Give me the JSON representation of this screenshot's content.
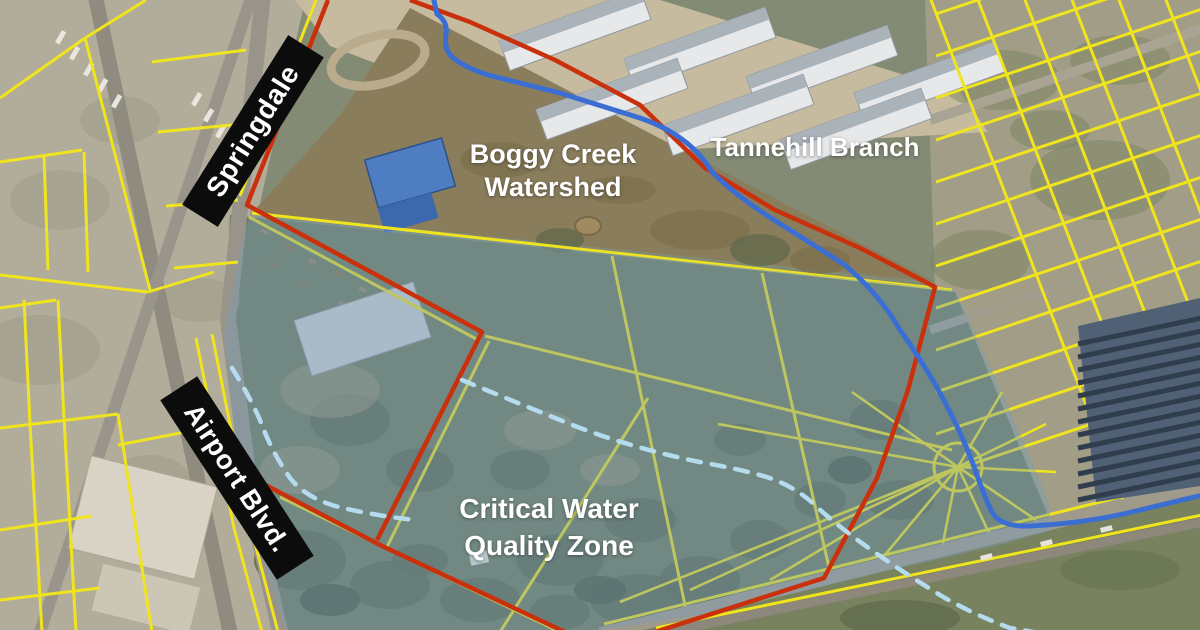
{
  "map": {
    "description": "Aerial parcel map with watershed and water quality zone overlays",
    "labels": {
      "springdale": "Springdale",
      "airport_blvd": "Airport Blvd.",
      "boggy_creek_line1": "Boggy Creek",
      "boggy_creek_line2": "Watershed",
      "tannehill_branch": "Tannehill Branch",
      "cwqz_line1": "Critical Water",
      "cwqz_line2": "Quality Zone"
    },
    "colors": {
      "parcel_lines": "#f0e41e",
      "property_boundary": "#c9300b",
      "creek": "#3b6ed2",
      "buffer_dashed": "#b5dcee",
      "zone_overlay": "rgba(120,158,186,0.42)",
      "banner_bg": "#0c0c0c",
      "label_text": "#ffffff"
    }
  }
}
